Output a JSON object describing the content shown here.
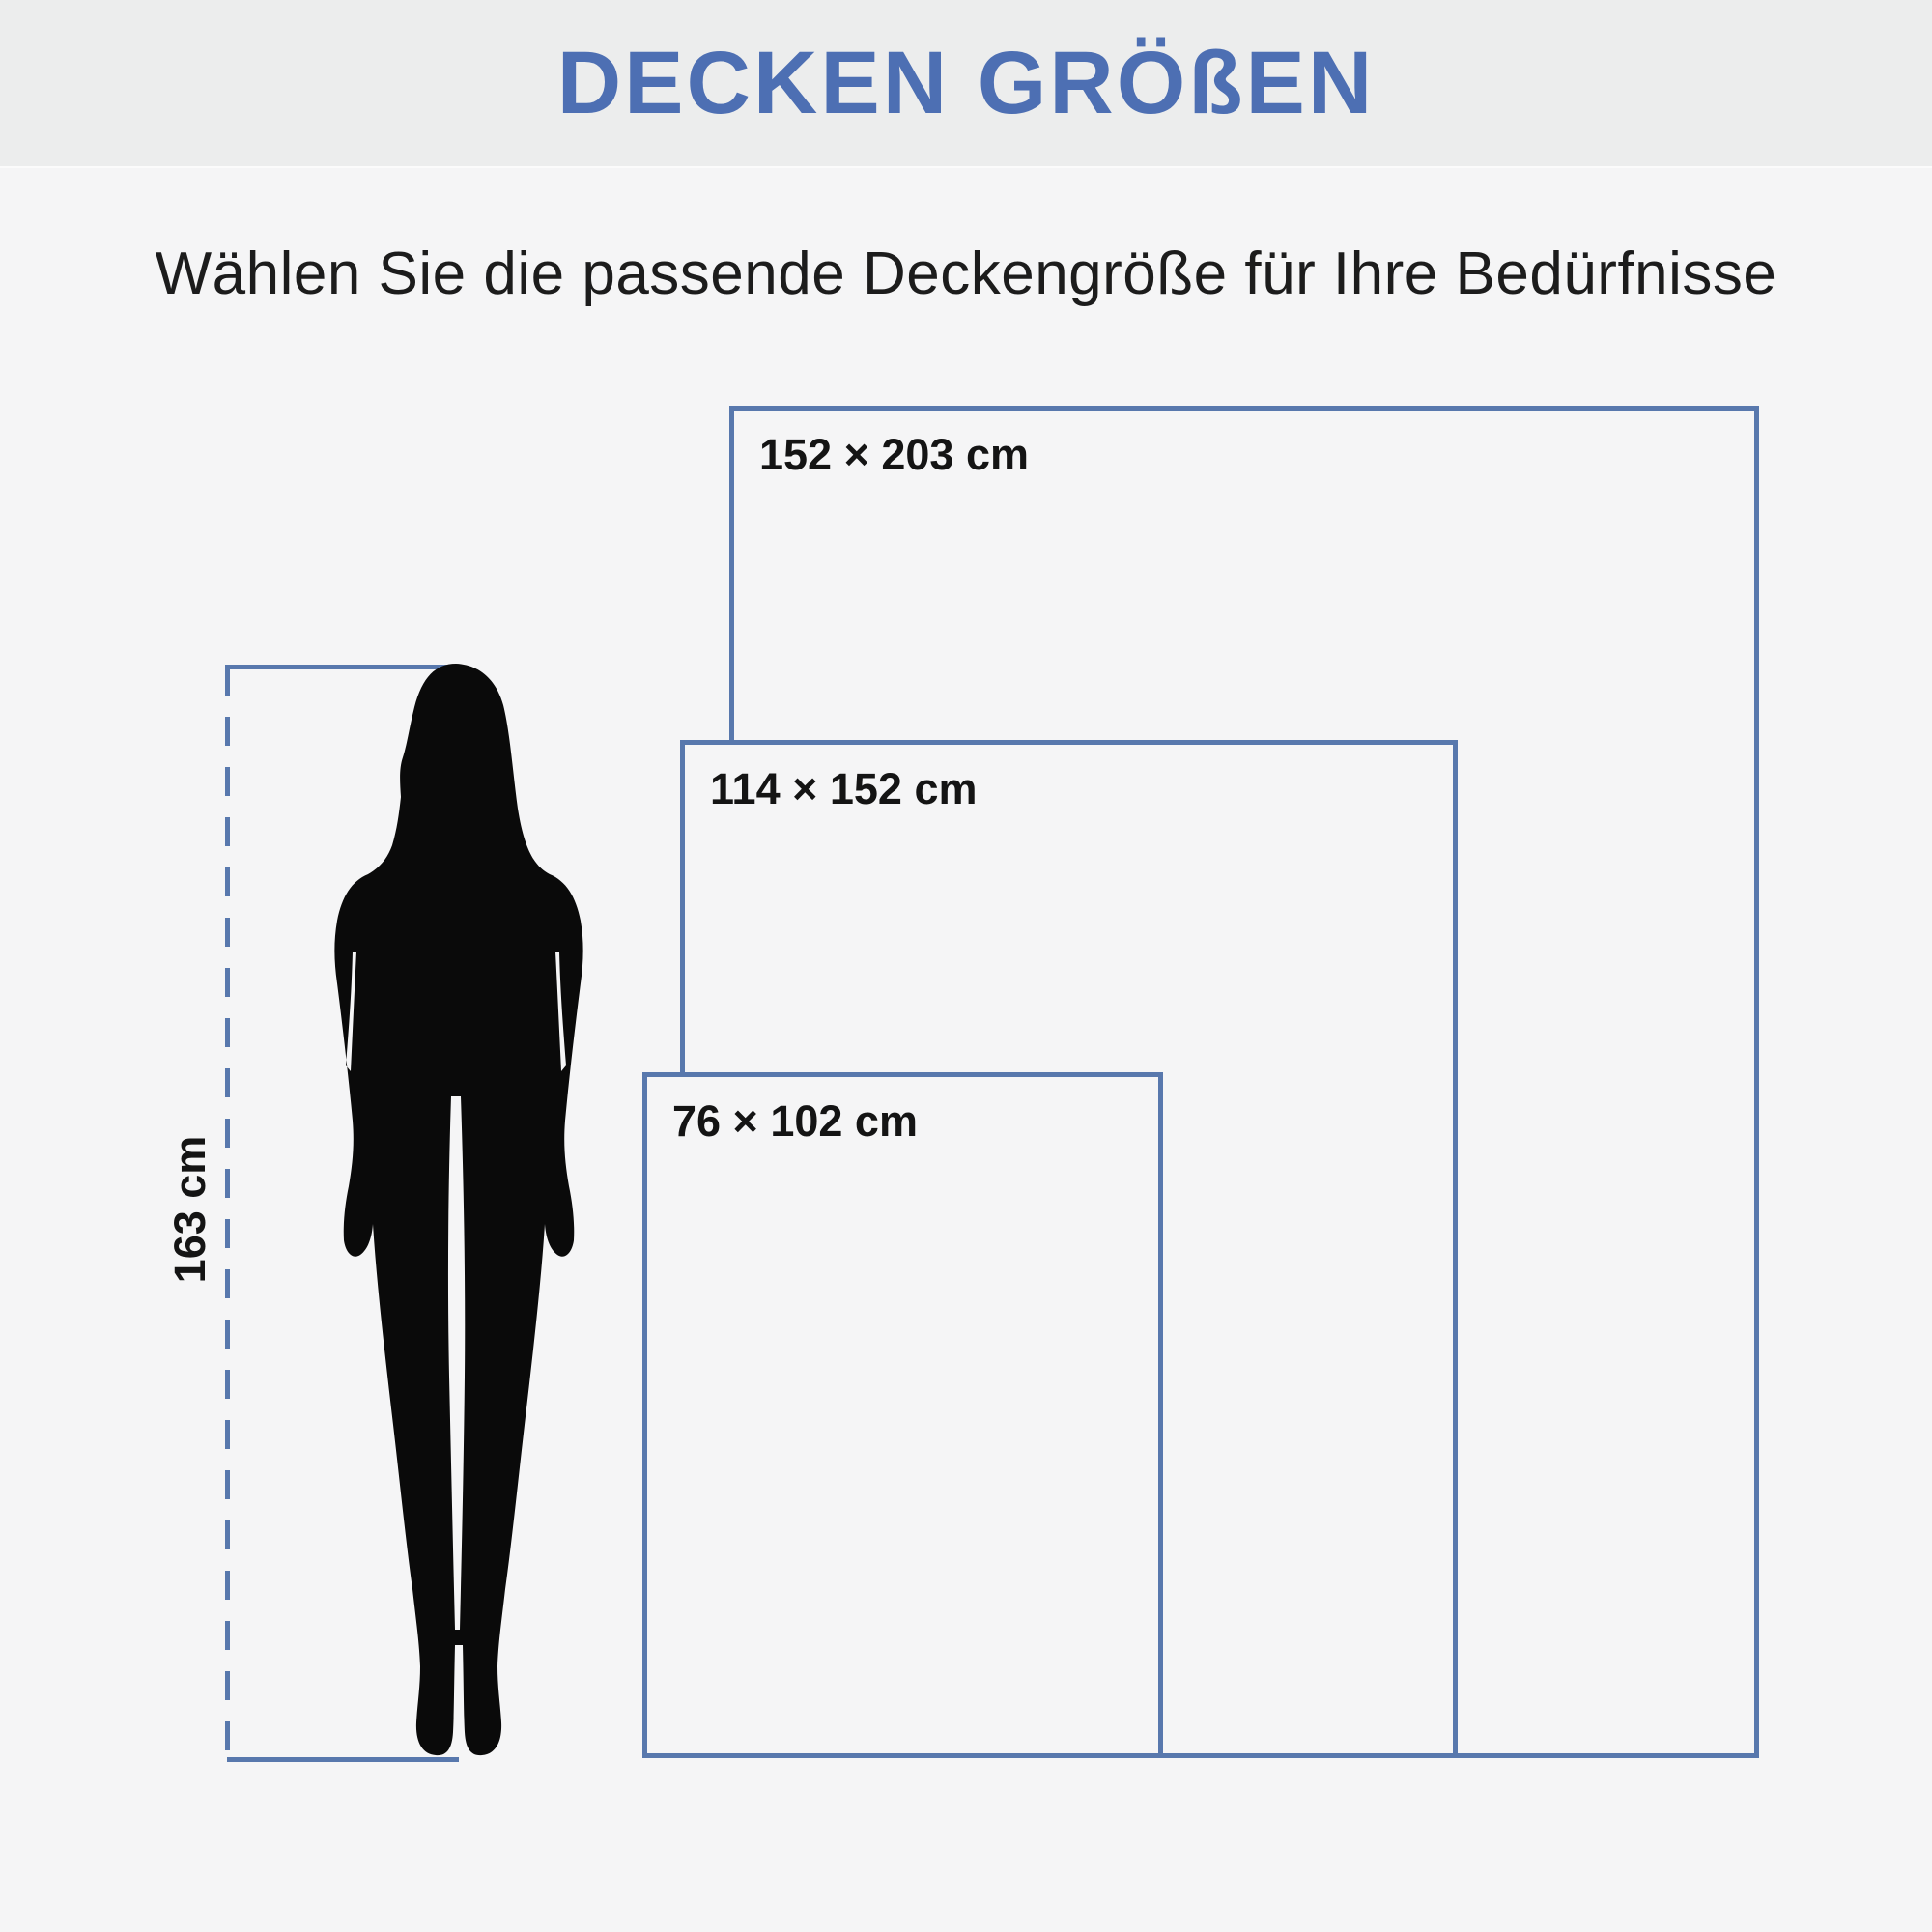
{
  "meta": {
    "accent": "#5878ad",
    "title_color": "#4d6fb3",
    "bg": "#f5f5f6",
    "header_bg": "#eceded",
    "silhouette_color": "#0a0a0a",
    "text_color": "#1c1c1c"
  },
  "header": {
    "title": "DECKEN GRÖßEN"
  },
  "intro": {
    "subtitle": "Wählen Sie die passende Deckengröße für Ihre Bedürfnisse"
  },
  "diagram": {
    "sizes": [
      {
        "label": "152 × 203 cm",
        "width_cm": 152,
        "height_cm": 203
      },
      {
        "label": "114 × 152 cm",
        "width_cm": 114,
        "height_cm": 152
      },
      {
        "label": "76 × 102 cm",
        "width_cm": 76,
        "height_cm": 102
      }
    ],
    "person": {
      "figure": "woman-silhouette",
      "height_label": "163 cm",
      "height_cm": 163
    }
  }
}
